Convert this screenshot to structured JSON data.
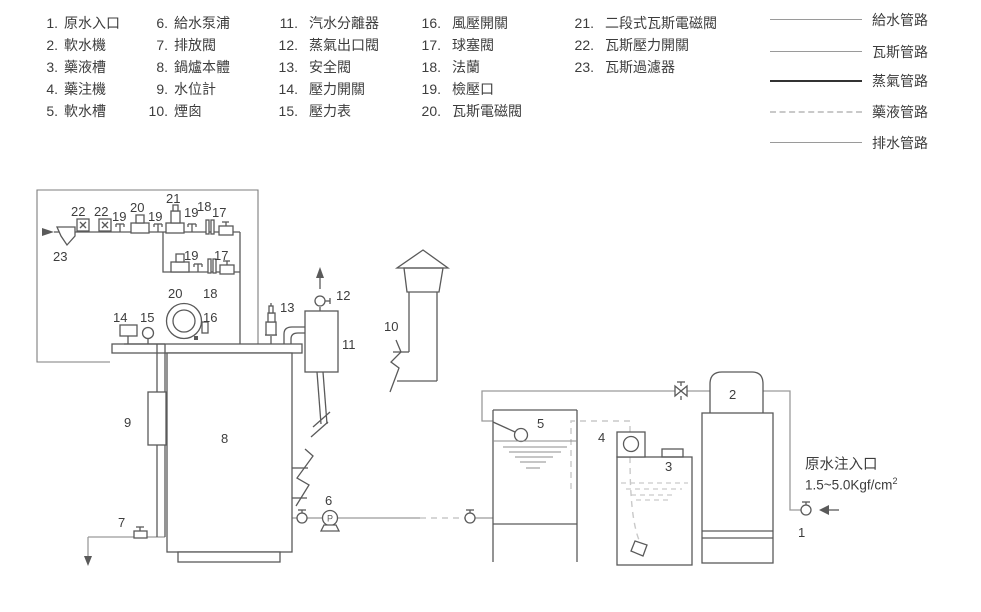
{
  "parts_legend": {
    "columns": [
      {
        "items": [
          {
            "num": "1.",
            "label": "原水入口"
          },
          {
            "num": "2.",
            "label": "軟水機"
          },
          {
            "num": "3.",
            "label": "藥液槽"
          },
          {
            "num": "4.",
            "label": "藥注機"
          },
          {
            "num": "5.",
            "label": "軟水槽"
          }
        ]
      },
      {
        "items": [
          {
            "num": "6.",
            "label": "給水泵浦"
          },
          {
            "num": "7.",
            "label": "排放閥"
          },
          {
            "num": "8.",
            "label": "鍋爐本體"
          },
          {
            "num": "9.",
            "label": "水位計"
          },
          {
            "num": "10.",
            "label": "煙囪"
          }
        ]
      },
      {
        "items": [
          {
            "num": "11.",
            "label": "汽水分離器"
          },
          {
            "num": "12.",
            "label": "蒸氣出口閥"
          },
          {
            "num": "13.",
            "label": "安全閥"
          },
          {
            "num": "14.",
            "label": "壓力開關"
          },
          {
            "num": "15.",
            "label": "壓力表"
          }
        ]
      },
      {
        "items": [
          {
            "num": "16.",
            "label": "風壓開關"
          },
          {
            "num": "17.",
            "label": "球塞閥"
          },
          {
            "num": "18.",
            "label": "法蘭"
          },
          {
            "num": "19.",
            "label": "檢壓口"
          },
          {
            "num": "20.",
            "label": "瓦斯電磁閥"
          }
        ]
      },
      {
        "items": [
          {
            "num": "21.",
            "label": "二段式瓦斯電磁閥"
          },
          {
            "num": "22.",
            "label": "瓦斯壓力開關"
          },
          {
            "num": "23.",
            "label": "瓦斯過濾器"
          }
        ]
      }
    ]
  },
  "line_legend": [
    {
      "label": "給水管路",
      "style": "thin"
    },
    {
      "label": "瓦斯管路",
      "style": "thin"
    },
    {
      "label": "蒸氣管路",
      "style": "thick"
    },
    {
      "label": "藥液管路",
      "style": "dashed"
    },
    {
      "label": "排水管路",
      "style": "thin"
    }
  ],
  "nums": {
    "1": "1",
    "2": "2",
    "3": "3",
    "4": "4",
    "5": "5",
    "6": "6",
    "7": "7",
    "8": "8",
    "9": "9",
    "10": "10",
    "11": "11",
    "12": "12",
    "13": "13",
    "14": "14",
    "15": "15",
    "16": "16",
    "17": "17",
    "18": "18",
    "19": "19",
    "20": "20",
    "21": "21",
    "22": "22",
    "23": "23",
    "P": "P"
  },
  "annotations": {
    "raw_water_inlet": "原水注入口",
    "pressure": "1.5~5.0Kgf/cm",
    "pressure_sup": "2"
  },
  "colors": {
    "line": "#5a5a5a",
    "water": "#9a9a9a",
    "chem": "#c9c9c9",
    "steam": "#333333",
    "text": "#3d3d3d",
    "bg": "#ffffff"
  }
}
